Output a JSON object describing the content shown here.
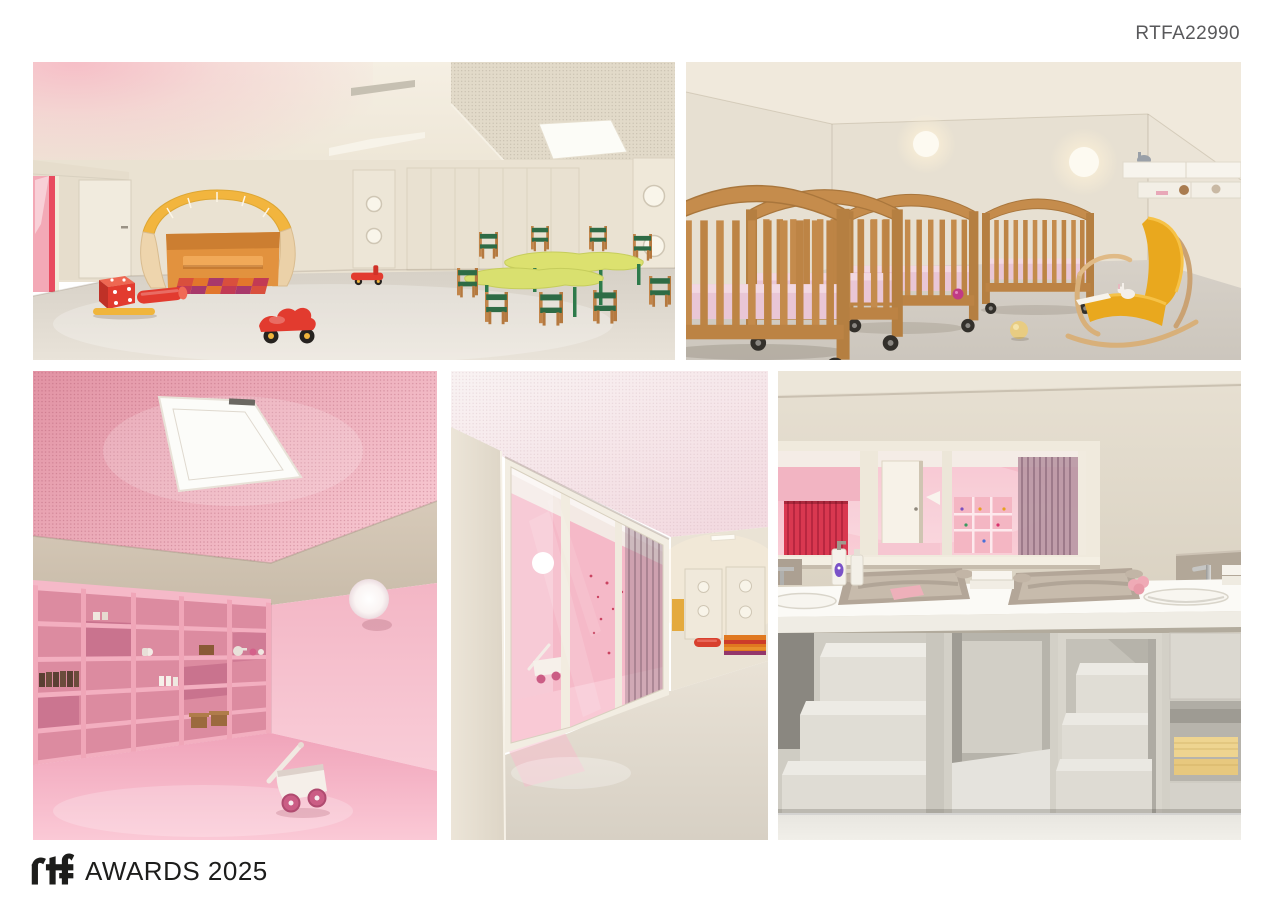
{
  "page": {
    "background": "#ffffff",
    "ref_code": "RTFA22990",
    "ref_code_color": "#59595b"
  },
  "logo": {
    "mark": "rtf",
    "text": "AWARDS 2025",
    "color": "#1d1d1b"
  },
  "board": {
    "rows": 2,
    "photos": [
      {
        "id": "playroom",
        "caption": "Nursery playroom: cream walls, pink glow, wooden play cabin with yellow slatted roof, colourful mat, red foam dice and cylinder, two red ride-on toy cars, kidney-shaped green tables with wooden toddler chairs, wardrobe wall and doors with porthole windows",
        "palette": {
          "wall": "#eae2d2",
          "floor": "#ddd7cc",
          "glow": "#f3b0bd",
          "red": "#e23b2f",
          "yellow": "#f0b53c",
          "table_green": "#d9e06f",
          "seat_green": "#2e6b45",
          "wood": "#c2854a"
        }
      },
      {
        "id": "sleeping-room",
        "caption": "Sleeping room: row of wooden cribs on casters with pink bedding, two glowing round wall lights, white wall shelf with plush toys, mustard-yellow bentwood rocking chair, yellow and pink balls on grey floor",
        "palette": {
          "wall": "#e7e0d2",
          "floor": "#d2ccc3",
          "crib_wood": "#c58c4c",
          "bedding": "#e9c6d6",
          "rocker": "#e9a81e"
        }
      },
      {
        "id": "pink-storage-room",
        "caption": "All-pink room: perforated pink acoustic ceiling with skylight, beige wall band, pink open shelving grid with small toys, white globe wall lamp, pink floor and a white wooden toy pram",
        "palette": {
          "ceiling": "#e9a2b0",
          "band": "#d0c3b2",
          "wall": "#f4bac8",
          "shelves": "#ee9db0",
          "floor": "#f5b0c2"
        }
      },
      {
        "id": "corridor",
        "caption": "Corridor looking through a glazed sliding wall into the pink room with sheer curtain, globe lamp and toy pram; beyond, two doors with porthole windows and orange-red floor mats",
        "palette": {
          "wall": "#e8e1d4",
          "ceiling": "#f6ecee",
          "pink_room": "#f5b9c8",
          "floor": "#e0d9cd",
          "mat_orange": "#e07820",
          "mat_red": "#d8402e"
        }
      },
      {
        "id": "changing-room",
        "caption": "Changing room: white counter with two taupe changing pads, integrated sinks and chrome taps, soap bottles and towels, pull-out step stairs and cubbies with yellow towels below, interior window onto the pink room with red and mauve curtains",
        "palette": {
          "wall": "#e0d9ca",
          "counter": "#fbfaf6",
          "pad": "#b3a698",
          "units": "#dcd9d1",
          "towels": "#eed490",
          "curtain_red": "#d93850",
          "curtain_mauve": "#ba98a5"
        }
      }
    ]
  }
}
